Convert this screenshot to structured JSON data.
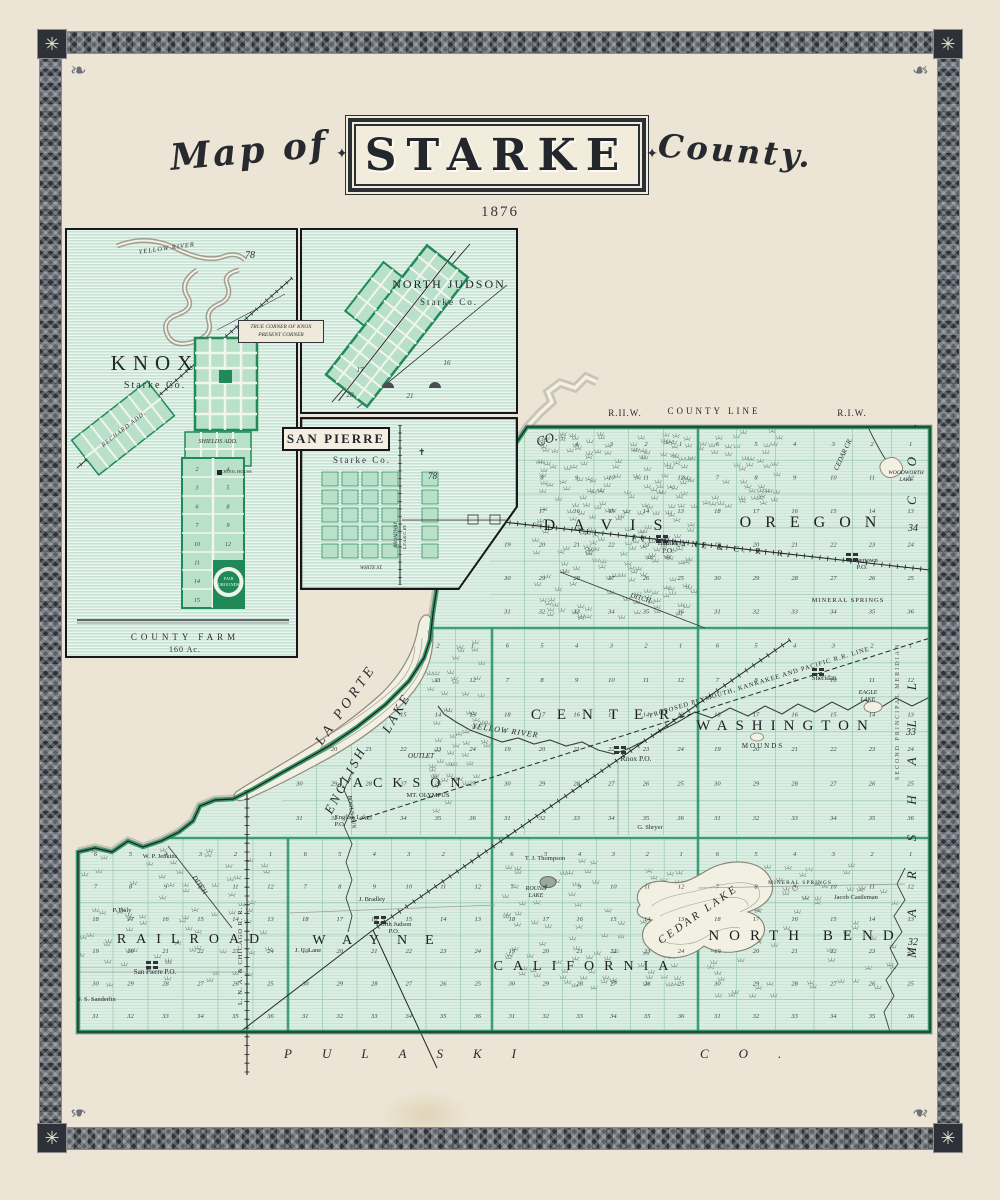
{
  "page": {
    "title_prefix": "Map of",
    "title_main": "STARKE",
    "title_suffix": "County.",
    "year": "1876"
  },
  "insets": {
    "knox": {
      "title": "KNOX",
      "subtitle": "Starke Co.",
      "river": "YELLOW RIVER",
      "plat_number": "78",
      "corner_note_1": "TRUE CORNER OF KNOX",
      "corner_note_2": "PRESENT CORNER",
      "rechard_add": "RECHARD ADD.",
      "shields_add": "SHIELDS ADD.",
      "school_house": "SCHOOL HOUSE",
      "fair_1": "FAIR",
      "fair_2": "GROUNDS",
      "farm_1": "COUNTY FARM",
      "farm_2": "160 Ac.",
      "blocks_left": [
        "2",
        "3",
        "6",
        "7",
        "10",
        "11",
        "14",
        "15"
      ],
      "blocks_right": [
        "4",
        "5",
        "8",
        "9",
        "12"
      ]
    },
    "north_judson": {
      "title": "NORTH JUDSON",
      "subtitle": "Starke Co.",
      "sections": [
        "17",
        "16",
        "20",
        "21"
      ]
    },
    "san_pierre": {
      "title": "SAN PIERRE",
      "subtitle": "Starke Co.",
      "plat_number": "78",
      "street_1": "BROADWAY",
      "street_2": "WHITE ST.",
      "railroad": "L.N.A.& C. RY."
    }
  },
  "map": {
    "townships": [
      {
        "id": "davis",
        "name": "DAVIS"
      },
      {
        "id": "oregon",
        "name": "OREGON"
      },
      {
        "id": "center",
        "name": "CENTER"
      },
      {
        "id": "washington",
        "name": "WASHINGTON"
      },
      {
        "id": "jackson",
        "name": "JACKSON"
      },
      {
        "id": "railroad",
        "name": "RAILROAD"
      },
      {
        "id": "wayne",
        "name": "WAYNE"
      },
      {
        "id": "california",
        "name": "CALIFORNIA"
      },
      {
        "id": "north_bend",
        "name": "NORTH BEND"
      }
    ],
    "section_rows": [
      [
        6,
        5,
        4,
        3,
        2,
        1
      ],
      [
        7,
        8,
        9,
        10,
        11,
        12
      ],
      [
        18,
        17,
        16,
        15,
        14,
        13
      ],
      [
        19,
        20,
        21,
        22,
        23,
        24
      ],
      [
        30,
        29,
        28,
        27,
        26,
        25
      ],
      [
        31,
        32,
        33,
        34,
        35,
        36
      ]
    ],
    "labels": [
      {
        "t": "R.II.W.",
        "x": 625,
        "y": 416,
        "s": 9,
        "ls": 1
      },
      {
        "t": "COUNTY LINE",
        "x": 714,
        "y": 414,
        "s": 9,
        "ls": 3
      },
      {
        "t": "R.I.W.",
        "x": 852,
        "y": 416,
        "s": 9,
        "ls": 1
      },
      {
        "t": "CO.",
        "x": 548,
        "y": 443,
        "r": -18,
        "s": 13,
        "i": 1
      },
      {
        "t": "LA PORTE",
        "x": 349,
        "y": 707,
        "r": -55,
        "s": 14,
        "ls": 4,
        "i": 1
      },
      {
        "t": "ENGLISH",
        "x": 349,
        "y": 782,
        "r": -62,
        "s": 13,
        "ls": 3,
        "i": 1
      },
      {
        "t": "LAKE",
        "x": 400,
        "y": 715,
        "r": -60,
        "s": 13,
        "ls": 3,
        "i": 1
      },
      {
        "t": "PULASKI",
        "x": 284,
        "y": 1058,
        "s": 13,
        "ls": 30,
        "i": 1,
        "a": "start"
      },
      {
        "t": "CO.",
        "x": 700,
        "y": 1058,
        "s": 13,
        "ls": 30,
        "i": 1,
        "a": "start"
      },
      {
        "t": "MARSHALL",
        "x": 916,
        "y": 958,
        "r": -90,
        "s": 13,
        "ls": 30,
        "i": 1,
        "a": "start"
      },
      {
        "t": "CO.",
        "x": 916,
        "y": 505,
        "r": -90,
        "s": 13,
        "ls": 30,
        "i": 1,
        "a": "start"
      },
      {
        "t": "SECOND PRINCIPAL MERIDIAN",
        "x": 899,
        "y": 780,
        "r": -90,
        "s": 6,
        "ls": 2,
        "a": "start",
        "c": "#555"
      },
      {
        "t": "34",
        "x": 913,
        "y": 531,
        "s": 10,
        "i": 1
      },
      {
        "t": "33",
        "x": 911,
        "y": 735,
        "s": 10,
        "i": 1
      },
      {
        "t": "32",
        "x": 913,
        "y": 945,
        "s": 10,
        "i": 1
      },
      {
        "t": "FT. WAYNE & C. R. R.",
        "x": 712,
        "y": 549,
        "r": 6,
        "s": 8.5,
        "ls": 4
      },
      {
        "t": "PROPOSED PLYMOUTH, KANKAKEE AND PACIFIC R.R. LINE",
        "x": 760,
        "y": 684,
        "r": -17,
        "s": 6.5,
        "ls": 1
      },
      {
        "t": "L. N. A. & CHICAGO R. R.",
        "x": 242,
        "y": 1005,
        "r": -90,
        "s": 6.5,
        "ls": 1,
        "a": "start"
      },
      {
        "t": "YELLOW RIVER",
        "x": 505,
        "y": 733,
        "r": 8,
        "s": 8,
        "i": 1,
        "ls": 1
      },
      {
        "t": "CEDAR CR.",
        "x": 845,
        "y": 455,
        "r": -65,
        "s": 7,
        "i": 1
      },
      {
        "t": "OUTLET",
        "x": 421,
        "y": 758,
        "s": 7,
        "i": 1
      },
      {
        "t": "DITCH",
        "x": 640,
        "y": 600,
        "r": 15,
        "s": 7,
        "i": 1
      },
      {
        "t": "DITCH",
        "x": 198,
        "y": 886,
        "r": 55,
        "s": 7,
        "i": 1
      },
      {
        "t": "BOGUS RUN",
        "x": 350,
        "y": 812,
        "r": 82,
        "s": 6,
        "i": 1
      },
      {
        "t": "CEDAR LAKE",
        "x": 700,
        "y": 917,
        "r": -35,
        "s": 11,
        "ls": 3,
        "i": 1
      },
      {
        "t": "ROUND",
        "x": 536,
        "y": 890,
        "s": 6,
        "i": 1
      },
      {
        "t": "LAKE",
        "x": 536,
        "y": 897,
        "s": 6,
        "i": 1
      },
      {
        "t": "EAGLE",
        "x": 868,
        "y": 694,
        "s": 6,
        "i": 1
      },
      {
        "t": "LAKE",
        "x": 868,
        "y": 701,
        "s": 6,
        "i": 1
      },
      {
        "t": "WOODWORTH",
        "x": 906,
        "y": 474,
        "s": 5.5,
        "i": 1
      },
      {
        "t": "LAKE",
        "x": 906,
        "y": 481,
        "s": 5.5,
        "i": 1
      },
      {
        "t": "MOUNDS",
        "x": 763,
        "y": 748,
        "s": 7,
        "ls": 2
      },
      {
        "t": "Hamlet",
        "x": 668,
        "y": 545,
        "s": 7
      },
      {
        "t": "P.O.",
        "x": 668,
        "y": 553,
        "s": 7
      },
      {
        "t": "Grovertown",
        "x": 862,
        "y": 562,
        "s": 6.5
      },
      {
        "t": "P.O.",
        "x": 862,
        "y": 569,
        "s": 6.5
      },
      {
        "t": "MINERAL SPRINGS",
        "x": 848,
        "y": 602,
        "s": 6.5,
        "ls": 1
      },
      {
        "t": "Sheridan",
        "x": 824,
        "y": 680,
        "s": 7
      },
      {
        "t": "Knox P.O.",
        "x": 636,
        "y": 761,
        "s": 7.5
      },
      {
        "t": "MT. OLYMPUS",
        "x": 428,
        "y": 797,
        "s": 6.5
      },
      {
        "t": "English Lake",
        "x": 352,
        "y": 819,
        "s": 6.5
      },
      {
        "t": "P.O.",
        "x": 340,
        "y": 826,
        "s": 6.5
      },
      {
        "t": "North Judson",
        "x": 394,
        "y": 926,
        "s": 6.5
      },
      {
        "t": "P.O.",
        "x": 394,
        "y": 933,
        "s": 6.5
      },
      {
        "t": "San Pierre P.O.",
        "x": 155,
        "y": 974,
        "s": 7
      },
      {
        "t": "P. Daly",
        "x": 122,
        "y": 912,
        "s": 6.5
      },
      {
        "t": "W. P. Jenkins",
        "x": 160,
        "y": 858,
        "s": 6.5
      },
      {
        "t": "J. S. Sanderlin",
        "x": 97,
        "y": 1001,
        "s": 6.5
      },
      {
        "t": "J. C. Lane",
        "x": 308,
        "y": 952,
        "s": 6.5
      },
      {
        "t": "J. Bradley",
        "x": 372,
        "y": 901,
        "s": 6.5
      },
      {
        "t": "T. J. Thompson",
        "x": 545,
        "y": 860,
        "s": 6.5
      },
      {
        "t": "G. Shryer",
        "x": 650,
        "y": 829,
        "s": 6.5
      },
      {
        "t": "Jacob Castleman",
        "x": 856,
        "y": 899,
        "s": 6.5
      },
      {
        "t": "MINERAL SPRINGS",
        "x": 800,
        "y": 884,
        "s": 5.5,
        "ls": 1
      }
    ]
  }
}
